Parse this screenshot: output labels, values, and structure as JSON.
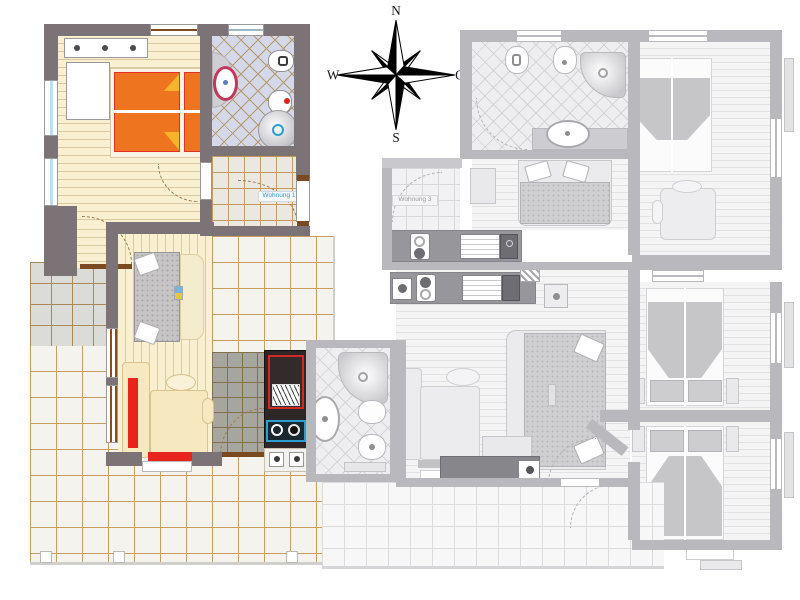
{
  "page": {
    "type": "apartment floor plan",
    "background": "#ffffff",
    "description": "Floor plan with one apartment highlighted in colour and neighbouring apartments greyed out"
  },
  "compass": {
    "north": "N",
    "east": "O",
    "south": "S",
    "west": "W"
  },
  "apartments": {
    "highlighted": {
      "label": "Wohnung 1",
      "label_color": "#2e9fd6",
      "state": "selected",
      "rooms": [
        "bedroom",
        "bathroom",
        "entrance-hall",
        "living-room",
        "kitchenette",
        "terrace"
      ],
      "furniture": [
        "double-bed",
        "dresser",
        "wardrobe",
        "washbasin",
        "toilet",
        "bidet",
        "shower",
        "day-bed",
        "corner-sofa",
        "armchair",
        "stove",
        "sink-unit",
        "hob-burners"
      ]
    },
    "greyed": {
      "label": "Wohnung 3",
      "label_color": "#9b9b9f",
      "state": "inactive",
      "rooms": [
        "bathroom",
        "bedroom",
        "entrance-hall",
        "kitchen",
        "living-room",
        "bedroom-2",
        "bedroom-3",
        "terrace",
        "balcony"
      ],
      "furniture": [
        "toilet",
        "bidet",
        "shower",
        "washbasin",
        "sofa-bed",
        "double-bed",
        "corner-sofa",
        "table",
        "hob",
        "sink-unit",
        "armchair"
      ]
    }
  },
  "colors": {
    "wall": "#7b7376",
    "wall_gray": "#b9b8bc",
    "wood_floor": "#f8f0d0",
    "wood_line": "#dbc9a2",
    "tile_grout": "#c79d62",
    "bath_tile": "#d4d8e9",
    "bed_orange": "#ee7420",
    "bed_fold_yellow": "#f5b42c",
    "accent_red": "#e8251d",
    "sofa_cream": "#f6e9c0",
    "kitchen_dark": "#2e2527",
    "stove_frame_red": "#cf2b24",
    "sink_frame_blue": "#2a9fd0",
    "gray_floor": "#f4f4f5",
    "gray_furniture": "#e9e9eb"
  }
}
